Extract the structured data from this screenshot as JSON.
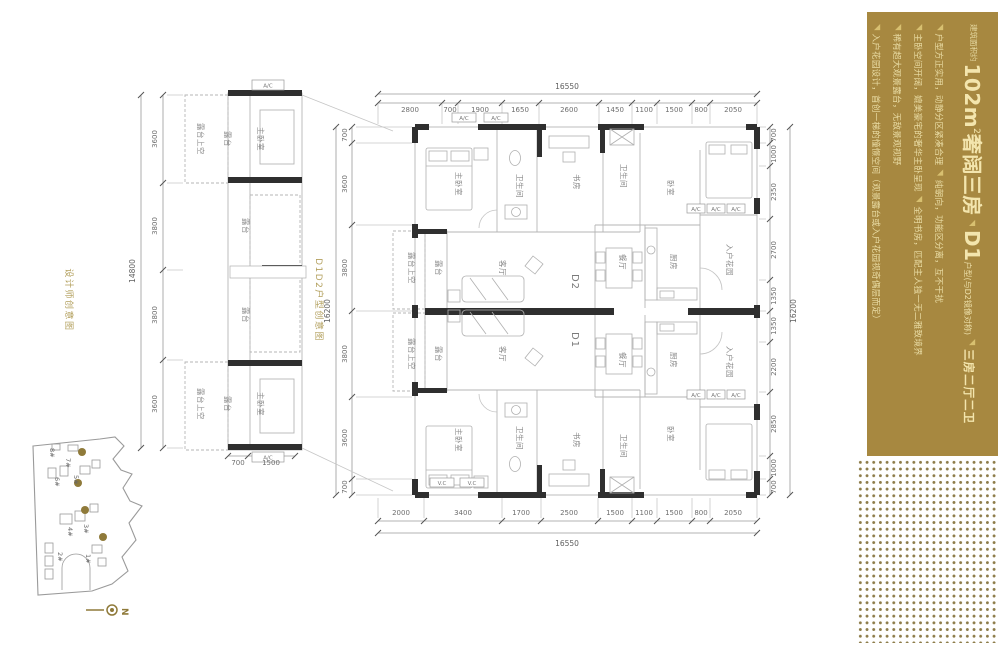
{
  "panel": {
    "accent_bg": "#a78840",
    "intro": "建筑面积约",
    "title_num": "102m",
    "title_sup": "2",
    "title_main": "奢阔三房",
    "mark": "◥",
    "title_d": "D1",
    "title_d_sub": "户型(与D2镜像对称)",
    "title_tail": "三房二厅二卫",
    "bullets": [
      {
        "lead": "户型方正实用，动静分区紧凑合理",
        "tail": "纯朝向，功能区分离，互不干扰"
      },
      {
        "lead": "主卧空间开阔，媲美豪宅的奢华主卧呈现",
        "tail": "全明书房，匹配主人独一无二雅致境界"
      },
      {
        "lead": "稀有超大观景露台，无敌景观视野",
        "tail": ""
      },
      {
        "lead": "入户花园设计，首创一梯的憧憬空间（观景露台或入户花园视奇偶层而定）",
        "tail": ""
      }
    ]
  },
  "captions": {
    "left": "设计师创意图",
    "schematic": "D1D2户型创意图"
  },
  "plan": {
    "dims_top": {
      "total": "16550",
      "segments": [
        "2800",
        "700",
        "1900",
        "1650",
        "2600",
        "1450",
        "1100",
        "1500",
        "800",
        "2050"
      ]
    },
    "dims_bottom": {
      "total": "16550",
      "segments": [
        "2000",
        "3400",
        "1700",
        "2500",
        "1500",
        "1100",
        "1500",
        "800",
        "2050"
      ]
    },
    "dims_left": {
      "total": "16200",
      "segments": [
        "700",
        "3600",
        "3800",
        "3800",
        "3600",
        "700"
      ]
    },
    "dims_right": {
      "total": "16200",
      "segments": [
        "700",
        "1000",
        "2350",
        "2700",
        "1350",
        "1350",
        "2200",
        "2850",
        "1000",
        "700"
      ]
    },
    "units": {
      "d2": "D2",
      "d1": "D1"
    },
    "rooms_d2": [
      "主卧室",
      "卫生间",
      "书房",
      "卫生间",
      "卧室",
      "餐厅",
      "厨房",
      "入户花园",
      "客厅",
      "露台",
      "露台上空"
    ],
    "rooms_d1": [
      "主卧室",
      "卫生间",
      "书房",
      "卫生间",
      "卧室",
      "餐厅",
      "厨房",
      "入户花园",
      "客厅",
      "露台",
      "露台上空"
    ],
    "ac_label": "A/C",
    "vc_label": "V.C"
  },
  "schematic": {
    "dims": {
      "total": "14800",
      "segments": [
        "3600",
        "3800",
        "3800",
        "3600"
      ],
      "bottom": [
        "700",
        "1500"
      ]
    },
    "labels": {
      "void": "露台上空",
      "balcony": "露台",
      "master": "主卧室",
      "ac": "A/C"
    }
  },
  "site": {
    "buildings": [
      "1#",
      "2#",
      "3#",
      "4#",
      "5#",
      "6#",
      "7#",
      "8#"
    ],
    "north": "N",
    "highlight_color": "#8f7a3a"
  }
}
